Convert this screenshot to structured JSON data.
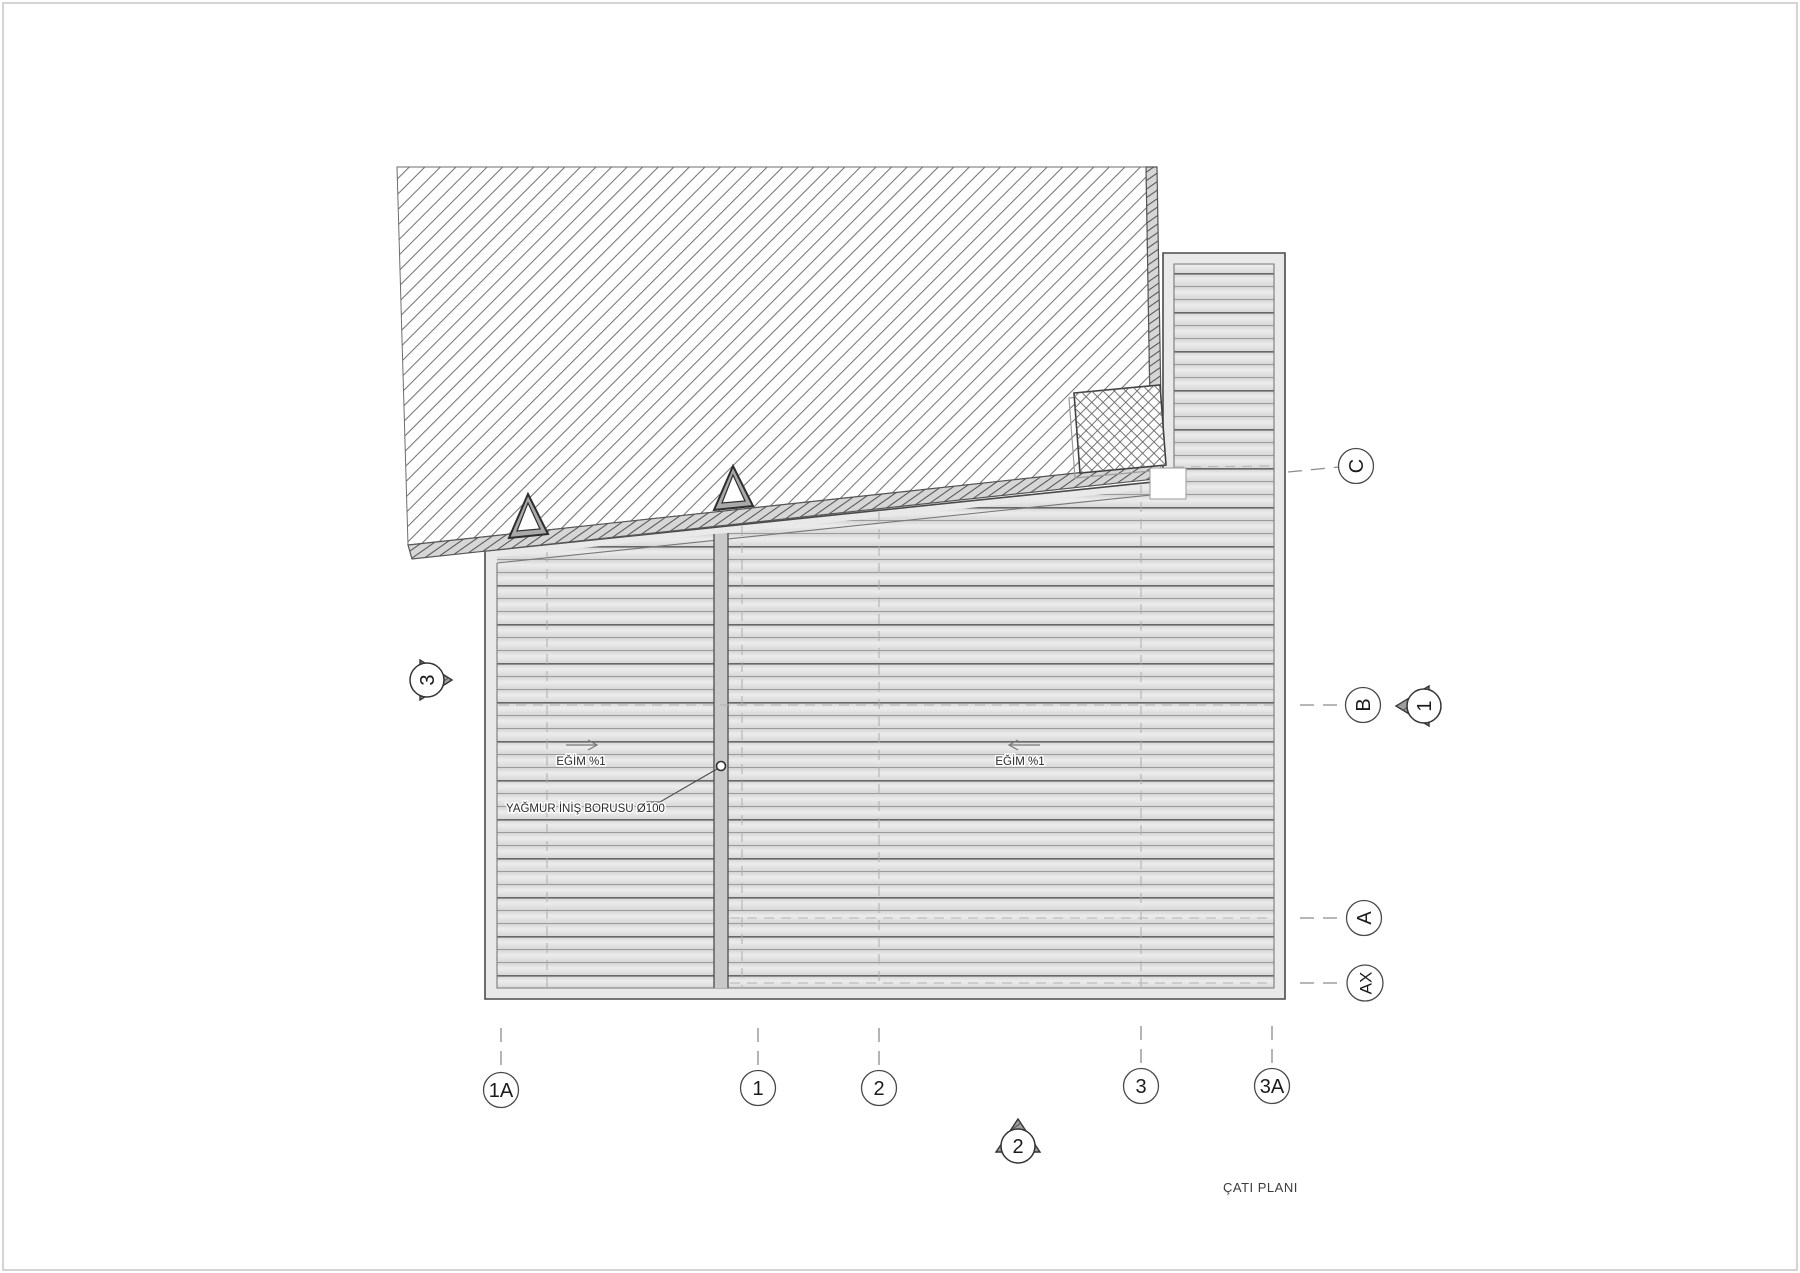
{
  "drawing": {
    "title": "ÇATI PLANI",
    "type_note": "roof plan"
  },
  "annotations": {
    "slope_left": {
      "text": "EĞİM %1"
    },
    "slope_right": {
      "text": "EĞİM %1"
    },
    "downpipe": {
      "text": "YAĞMUR İNİŞ BORUSU Ø100"
    }
  },
  "grid": {
    "bottom": [
      {
        "label": "1A"
      },
      {
        "label": "1"
      },
      {
        "label": "2"
      },
      {
        "label": "3"
      },
      {
        "label": "3A"
      }
    ],
    "right": [
      {
        "label": "C"
      },
      {
        "label": "B"
      },
      {
        "label": "A"
      },
      {
        "label": "AX"
      }
    ]
  },
  "section_markers": {
    "left": {
      "label": "3"
    },
    "right": {
      "label": "1"
    },
    "bottom": {
      "label": "2"
    }
  },
  "colors": {
    "paper": "#ffffff",
    "hatch_line": "#757575",
    "roof_panel_fill": "#e2e2e2",
    "panel_line_light": "#9b9b9b",
    "panel_line_dark": "#6b6b6b",
    "outline": "#4a4a4a",
    "dashed_axis": "#8c8c8c"
  }
}
